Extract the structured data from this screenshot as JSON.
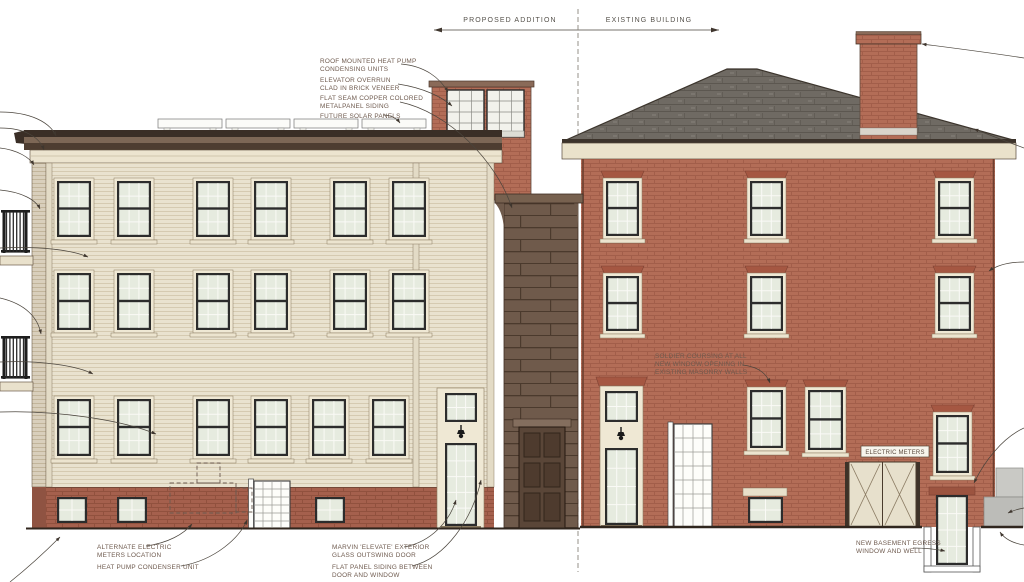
{
  "drawing": {
    "type": "architectural elevation - proposed addition and existing building",
    "dimension_bar": {
      "left_label": "PROPOSED ADDITION",
      "right_label": "EXISTING BUILDING"
    },
    "callouts": {
      "roof_heat_pump": {
        "l1": "ROOF MOUNTED HEAT PUMP",
        "l2": "CONDENSING UNITS"
      },
      "elevator_overrun": {
        "l1": "ELEVATOR OVERRUN",
        "l2": "CLAD IN BRICK VENEER"
      },
      "copper_siding": {
        "l1": "FLAT SEAM COPPER COLORED",
        "l2": "METALPANEL SIDING"
      },
      "solar_panels": {
        "l1": "FUTURE SOLAR PANELS"
      },
      "soldier_coursing": {
        "l1": "SOLDIER COURSING AT ALL",
        "l2": "NEW WINDOW OPENING IN",
        "l3": "EXISTING MASONRY WALLS"
      },
      "alt_electric_meters": {
        "l1": "ALTERNATE ELECTRIC",
        "l2": "METERS LOCATION"
      },
      "heat_pump_condenser": {
        "l1": "HEAT PUMP CONDENSER UNIT"
      },
      "marvin_door": {
        "l1": "MARVIN 'ELEVATE' EXTERIOR",
        "l2": "GLASS OUTSWING DOOR"
      },
      "flat_panel_siding": {
        "l1": "FLAT PANEL SIDING BETWEEN",
        "l2": "DOOR AND WINDOW"
      },
      "basement_egress": {
        "l1": "NEW BASEMENT EGRESS",
        "l2": "WINDOW AND WELL"
      },
      "electric_meters": "ELECTRIC METERS"
    },
    "colors": {
      "addition_siding": "#e9e2cf",
      "existing_brick": "#b36d57",
      "copper_connector": "#6f5a4b",
      "roof_shingle": "#6f6a63",
      "trim_cream": "#ece4cf",
      "base_brick": "#a5604d",
      "annotation_text": "#6e5a4e"
    }
  }
}
